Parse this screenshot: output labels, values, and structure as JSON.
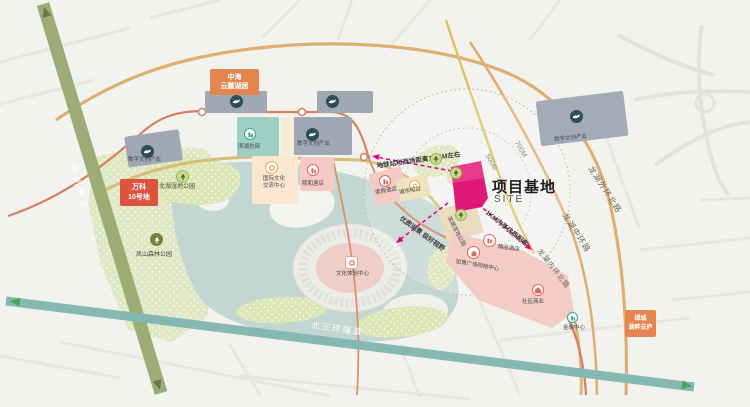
{
  "site": {
    "label": "项目基地",
    "sublabel": "SITE"
  },
  "roads": {
    "zhongzhou": "中州大道",
    "third_ring": "北三环隧道",
    "outer": "龙湖外环北路",
    "middle": "龙湖中环路",
    "inner": "龙湖内环北路",
    "d500": "500M",
    "d700": "700M"
  },
  "annotations": {
    "metro": "地铁站和商场距离1.2KM左右",
    "view": "优质湖景 极好视野",
    "amenity": "1KM内享优质配套"
  },
  "estates": {
    "zhonghai": {
      "line1": "中海",
      "line2": "云麓湖居"
    },
    "vanke": {
      "line1": "万科",
      "line2": "10号地"
    },
    "greentown": {
      "line1": "绿城",
      "line2": "湖畔云庐"
    }
  },
  "blocks": {
    "digital_industry": "数字文创产业",
    "binhu_hq": "滨湖总部",
    "intl_line1": "国际文化",
    "intl_line2": "交流中心",
    "xihe_hotel": "熙和酒店",
    "resort_hotel": "度假酒店",
    "boutique_hotel": "精品酒店",
    "mall": "如意广场购物中心",
    "retail": "社区商业",
    "finance": "金融中心",
    "balcony": "城市阳台",
    "lakeside_park": "滨湖湿地公园",
    "experience": "文化体验中心"
  },
  "parks": {
    "north_wetland": "北湖湿地公园",
    "forest": "凤山森林公园"
  },
  "colors": {
    "site_magenta": "#DE1A76",
    "annotation_magenta": "#E5007D",
    "estate_orange": "#E5854F",
    "estate_red": "#DD5340",
    "road_tan": "#DFAF72",
    "road_olive": "#9DAC74",
    "road_teal": "#85B8B2",
    "block_gray": "#9FA8B3",
    "block_teal": "#9FCEC2",
    "block_pink": "#F5CAC4",
    "block_cream": "#FBE7CF",
    "park_green": "#DFE7C4",
    "water_teal": "#C3D7D2"
  }
}
